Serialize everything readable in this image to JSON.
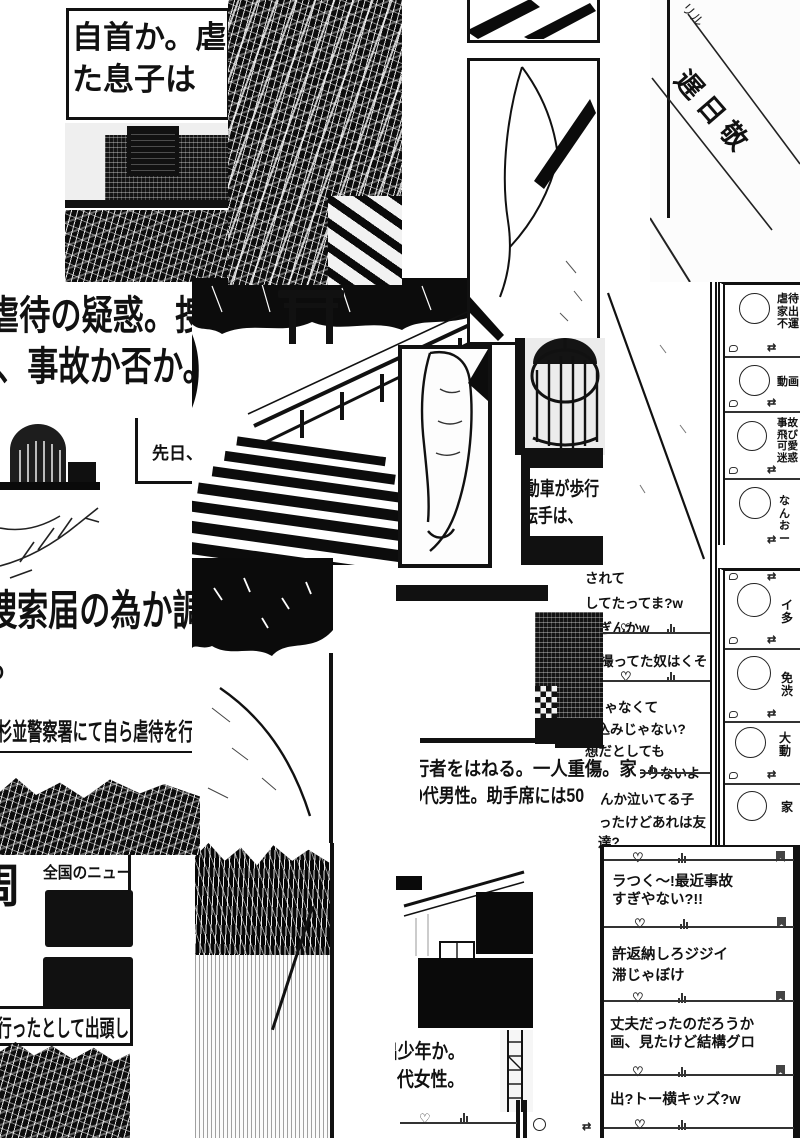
{
  "colors": {
    "ink": "#111111",
    "paper": "#ffffff"
  },
  "icons": {
    "heart": "♡",
    "retweet": "⇄"
  },
  "sign": {
    "text": "遅日敬",
    "marks": "リル"
  },
  "news": {
    "surrender": [
      "自首か。虐",
      "た息子は"
    ],
    "suspicion": [
      "虐待の疑惑。捜",
      "、事故か否か。"
    ],
    "recently": "先日、",
    "search_report": [
      "捜索届の為か調",
      "。"
    ],
    "police_station": "杉並警察署にて自ら虐待を行",
    "national_partial": "周",
    "national": "全国のニュー",
    "turned_in": "行ったとして出頭し",
    "car_caption": [
      "動車が歩行",
      "転手は、"
    ],
    "accident": [
      "行者をはねる。一人重傷。家",
      "60代男性。助手席には50"
    ],
    "runaway": [
      "出少年か。",
      "代女性。"
    ]
  },
  "feed_right_top": {
    "p1": [
      "虐待",
      "家出",
      "不運"
    ],
    "p2": [
      "動画"
    ],
    "p3": [
      "事故",
      "飛び",
      "可愛",
      "迷惑"
    ],
    "p4": [
      "なん",
      "おー"
    ]
  },
  "feed_right_mid": {
    "p1": [
      "イ",
      "多"
    ],
    "p2": [
      "免",
      "渋"
    ],
    "p3": [
      "大",
      "動"
    ],
    "p4": [
      "家"
    ]
  },
  "comments": {
    "p1": [
      "されて",
      "してたってま?w",
      "すぎんかw"
    ],
    "p2": [
      "撮ってた奴はくそ"
    ],
    "p3": [
      "じゃなくて",
      "び込みじゃない?",
      "想だとしても",
      "なのは変わりないよ"
    ],
    "p4": [
      "んか泣いてる子",
      "ったけどあれは友達?"
    ]
  },
  "feed_bottom": {
    "p1": [
      "ラつく〜!最近事故",
      "すぎやない?!!"
    ],
    "p2": [
      "許返納しろジジイ",
      "滞じゃぼけ"
    ],
    "p3": [
      "丈夫だったのだろうか",
      "画、見たけど結構グロ"
    ],
    "p4": [
      "出?トー横キッズ?w"
    ]
  }
}
